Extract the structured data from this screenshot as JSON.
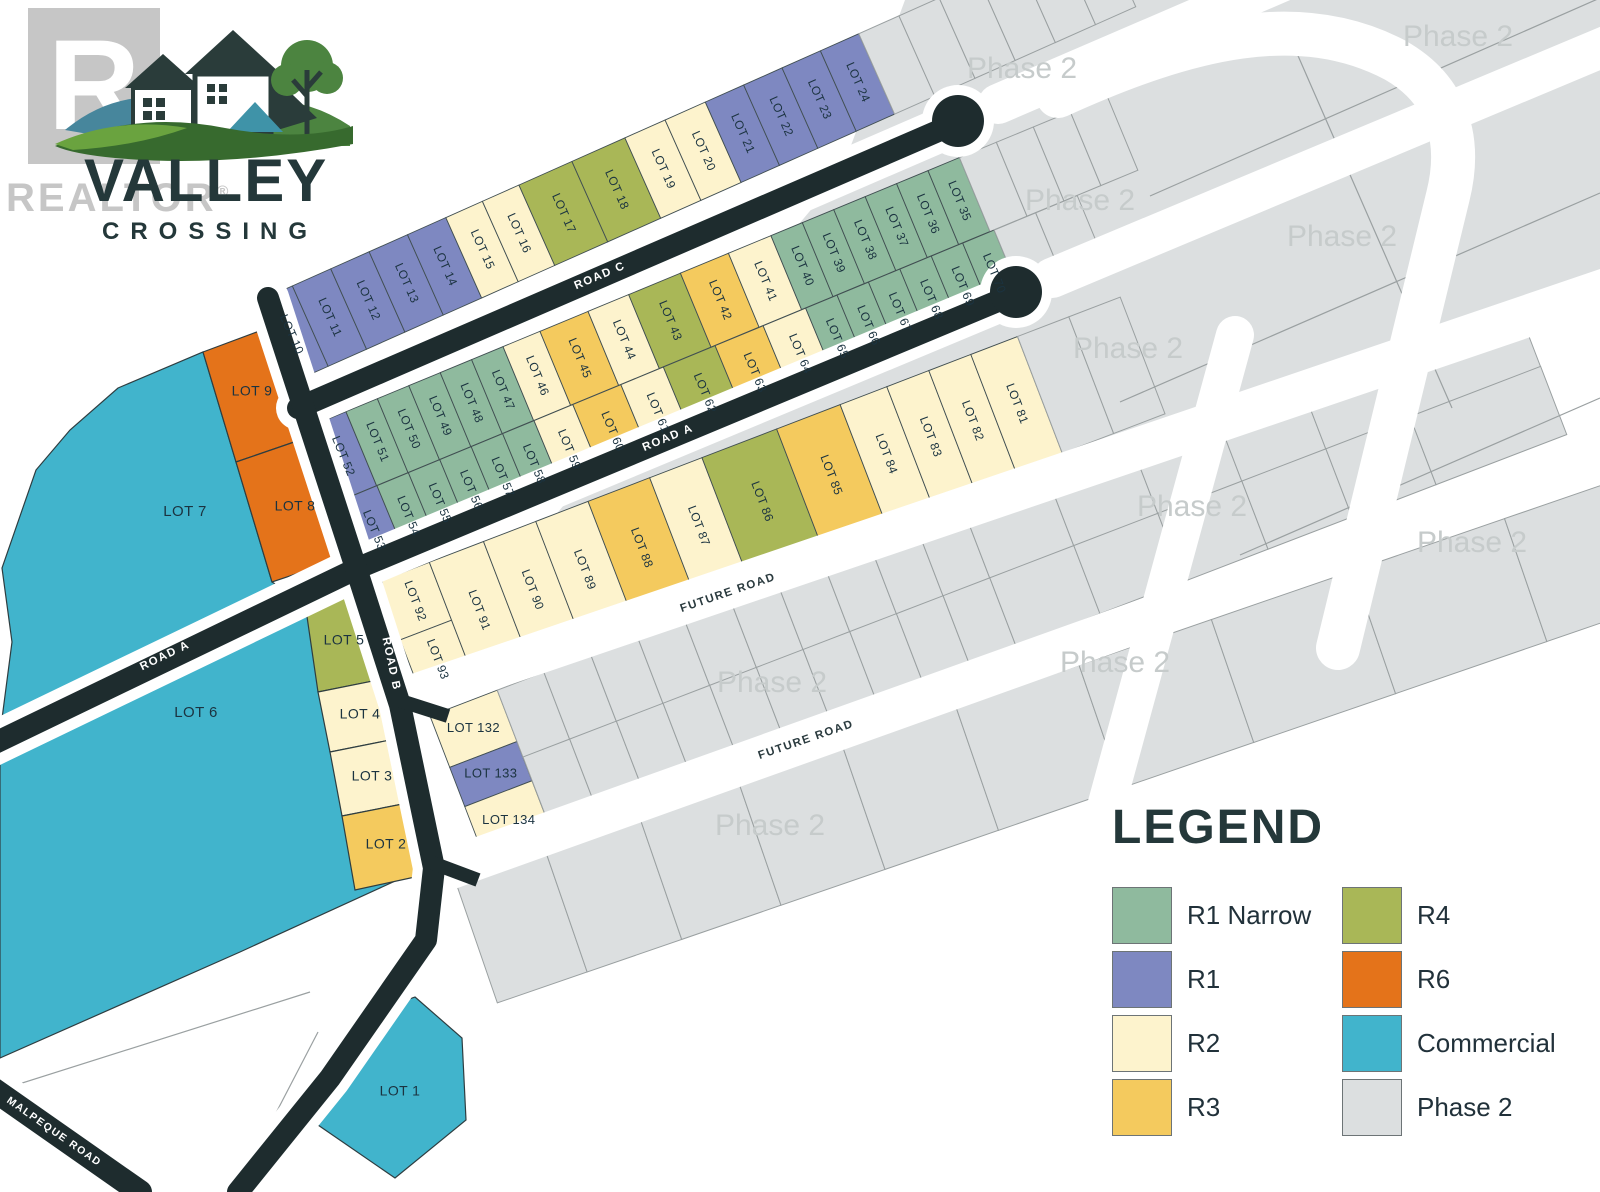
{
  "palette": {
    "r1n": "#8fba9e",
    "r1": "#7e88c1",
    "r2": "#fdf3cd",
    "r3": "#f4ca5e",
    "r4": "#a9b757",
    "r6": "#e4731a",
    "com": "#41b4cc",
    "ph2": "#dcdfe0",
    "road": "#1e2c2e",
    "lot_stroke": "#41505338",
    "label": "#1b3340",
    "ph2_stroke": "#9aa0a1",
    "watermark": "#c6cbcb"
  },
  "logo": {
    "title": "VALLEY",
    "subtitle": "CROSSING",
    "watermark_letter": "R",
    "watermark_text": "REALTOR",
    "registered": "®"
  },
  "legend": {
    "title": "LEGEND",
    "items": [
      {
        "label": "R1 Narrow",
        "zone": "r1n"
      },
      {
        "label": "R4",
        "zone": "r4"
      },
      {
        "label": "R1",
        "zone": "r1"
      },
      {
        "label": "R6",
        "zone": "r6"
      },
      {
        "label": "R2",
        "zone": "r2"
      },
      {
        "label": "Commercial",
        "zone": "com"
      },
      {
        "label": "R3",
        "zone": "r3"
      },
      {
        "label": "Phase 2",
        "zone": "ph2"
      }
    ]
  },
  "map": {
    "watermark_text": "Phase 2",
    "base": {
      "pts": "840,175 905,0 1600,0 1600,286 405,695"
    },
    "rows": [
      {
        "id": "band-1-north-of-road-c",
        "ox": 254,
        "oy": 303,
        "a": -24,
        "h": 88,
        "cells": [
          [
            "LOT 10",
            "r1",
            42
          ],
          [
            "LOT 11",
            "r1",
            42
          ],
          [
            "LOT 12",
            "r1",
            42
          ],
          [
            "LOT 13",
            "r1",
            42
          ],
          [
            "LOT 14",
            "r1",
            42
          ],
          [
            "LOT 15",
            "r2",
            40
          ],
          [
            "LOT 16",
            "r2",
            40
          ],
          [
            "LOT 17",
            "r4",
            58
          ],
          [
            "LOT 18",
            "r4",
            58
          ],
          [
            "LOT 19",
            "r2",
            44
          ],
          [
            "LOT 20",
            "r2",
            44
          ],
          [
            "LOT 21",
            "r1",
            42
          ],
          [
            "LOT 22",
            "r1",
            42
          ],
          [
            "LOT 23",
            "r1",
            42
          ],
          [
            "LOT 24",
            "r1",
            42
          ],
          [
            "",
            "ph2",
            44
          ],
          [
            "",
            "ph2",
            44
          ],
          [
            "",
            "ph2",
            44
          ],
          [
            "",
            "ph2",
            44
          ],
          [
            "",
            "ph2",
            44
          ],
          [
            "",
            "ph2",
            44
          ]
        ]
      },
      {
        "id": "band-2-facing-road-c",
        "ox": 309,
        "oy": 427,
        "a": -22.5,
        "h": 80,
        "cells": [
          [
            "LOT 52",
            "r1",
            40
          ],
          [
            "LOT 51",
            "r1n",
            34
          ],
          [
            "LOT 50",
            "r1n",
            34
          ],
          [
            "LOT 49",
            "r1n",
            34
          ],
          [
            "LOT 48",
            "r1n",
            34
          ],
          [
            "LOT 47",
            "r1n",
            34
          ],
          [
            "LOT 46",
            "r2",
            40
          ],
          [
            "LOT 45",
            "r3",
            52
          ],
          [
            "LOT 44",
            "r2",
            44
          ],
          [
            "LOT 43",
            "r4",
            56
          ],
          [
            "LOT 42",
            "r3",
            52
          ],
          [
            "LOT 41",
            "r2",
            46
          ],
          [
            "LOT 40",
            "r1n",
            34
          ],
          [
            "LOT 39",
            "r1n",
            34
          ],
          [
            "LOT 38",
            "r1n",
            34
          ],
          [
            "LOT 37",
            "r1n",
            34
          ],
          [
            "LOT 36",
            "r1n",
            34
          ],
          [
            "LOT 35",
            "r1n",
            34
          ],
          [
            "",
            "ph2",
            40
          ],
          [
            "",
            "ph2",
            40
          ],
          [
            "",
            "ph2",
            40
          ],
          [
            "",
            "ph2",
            40
          ]
        ]
      },
      {
        "id": "band-2-facing-road-a",
        "ox": 340,
        "oy": 501,
        "a": -22.5,
        "h": 80,
        "cells": [
          [
            "LOT 53",
            "r1",
            40
          ],
          [
            "LOT 54",
            "r1n",
            34
          ],
          [
            "LOT 55",
            "r1n",
            34
          ],
          [
            "LOT 56",
            "r1n",
            34
          ],
          [
            "LOT 57",
            "r1n",
            34
          ],
          [
            "LOT 58",
            "r1n",
            34
          ],
          [
            "LOT 59",
            "r2",
            42
          ],
          [
            "LOT 60",
            "r3",
            52
          ],
          [
            "LOT 61",
            "r2",
            46
          ],
          [
            "LOT 62",
            "r4",
            56
          ],
          [
            "LOT 63",
            "r3",
            52
          ],
          [
            "LOT 64",
            "r2",
            46
          ],
          [
            "LOT 65",
            "r1n",
            34
          ],
          [
            "LOT 66",
            "r1n",
            34
          ],
          [
            "LOT 67",
            "r1n",
            34
          ],
          [
            "LOT 68",
            "r1n",
            34
          ],
          [
            "LOT 69",
            "r1n",
            34
          ],
          [
            "LOT 70",
            "r1n",
            34
          ],
          [
            "",
            "ph2",
            45
          ],
          [
            "",
            "ph2",
            45
          ]
        ]
      },
      {
        "id": "band-3-south-of-road-a",
        "ox": 378,
        "oy": 582,
        "a": -21,
        "h": 125,
        "cells": [
          [
            "LOT 92",
            "r2",
            55,
            62
          ],
          [
            "LOT 93",
            "r2",
            55,
            63,
            62,
            1
          ],
          [
            "LOT 91",
            "r2",
            58
          ],
          [
            "LOT 90",
            "r2",
            56
          ],
          [
            "LOT 89",
            "r2",
            56
          ],
          [
            "LOT 88",
            "r3",
            66
          ],
          [
            "LOT 87",
            "r2",
            56
          ],
          [
            "LOT 86",
            "r4",
            80
          ],
          [
            "LOT 85",
            "r3",
            68
          ],
          [
            "LOT 84",
            "r2",
            50
          ],
          [
            "LOT 83",
            "r2",
            45
          ],
          [
            "LOT 82",
            "r2",
            45
          ],
          [
            "LOT 81",
            "r2",
            50
          ],
          [
            "",
            "ph2",
            55
          ],
          [
            "",
            "ph2",
            55
          ]
        ]
      },
      {
        "id": "band-4-between-future-roads",
        "ox": 430,
        "oy": 716,
        "a": -21,
        "h": 145,
        "cells": [
          [
            "LOT 132",
            "r2",
            72,
            55,
            0,
            0,
            1
          ],
          [
            "LOT 133",
            "r1",
            72,
            42,
            55,
            1,
            1
          ],
          [
            "LOT 134",
            "r2",
            72,
            58,
            97,
            1,
            1
          ],
          [
            "",
            "ph2",
            50,
            72
          ],
          [
            "",
            "ph2",
            50,
            72
          ],
          [
            "",
            "ph2",
            50,
            72
          ],
          [
            "",
            "ph2",
            50,
            72
          ],
          [
            "",
            "ph2",
            50,
            72
          ],
          [
            "",
            "ph2",
            50,
            72
          ],
          [
            "",
            "ph2",
            50,
            72
          ],
          [
            "",
            "ph2",
            50,
            72
          ],
          [
            "",
            "ph2",
            50,
            72
          ],
          [
            "",
            "ph2",
            50,
            72
          ],
          [
            "",
            "ph2",
            90,
            72
          ],
          [
            "",
            "ph2",
            90,
            72
          ],
          [
            "",
            "ph2",
            90,
            72
          ],
          [
            "",
            "ph2",
            90,
            72
          ],
          [
            "",
            "ph2",
            90,
            72
          ],
          [
            "",
            "ph2",
            140,
            72
          ]
        ]
      },
      {
        "id": "band-4-lower-row",
        "ox": 523,
        "oy": 757,
        "a": -21,
        "h": 73,
        "cells": [
          [
            "",
            "ph2",
            50
          ],
          [
            "",
            "ph2",
            50
          ],
          [
            "",
            "ph2",
            50
          ],
          [
            "",
            "ph2",
            50
          ],
          [
            "",
            "ph2",
            50
          ],
          [
            "",
            "ph2",
            50
          ],
          [
            "",
            "ph2",
            50
          ],
          [
            "",
            "ph2",
            50
          ],
          [
            "",
            "ph2",
            50
          ],
          [
            "",
            "ph2",
            50
          ],
          [
            "",
            "ph2",
            90
          ],
          [
            "",
            "ph2",
            90
          ],
          [
            "",
            "ph2",
            90
          ],
          [
            "",
            "ph2",
            90
          ],
          [
            "",
            "ph2",
            90
          ],
          [
            "",
            "ph2",
            140
          ]
        ]
      },
      {
        "id": "band-5-south-of-future-road-2",
        "ox": 455,
        "oy": 880,
        "a": -19,
        "h": 130,
        "cells": [
          [
            "",
            "ph2",
            95
          ],
          [
            "",
            "ph2",
            100
          ],
          [
            "",
            "ph2",
            105
          ],
          [
            "",
            "ph2",
            110
          ],
          [
            "",
            "ph2",
            120
          ],
          [
            "",
            "ph2",
            130
          ],
          [
            "",
            "ph2",
            140
          ],
          [
            "",
            "ph2",
            150
          ],
          [
            "",
            "ph2",
            160
          ],
          [
            "",
            "ph2",
            115
          ]
        ]
      }
    ],
    "polys": [
      {
        "t": "LOT 7",
        "z": "com",
        "pts": "118,388 203,352 236,462 272,582 288,592 0,734 12,642 2,568 36,470 70,430",
        "lx": 185,
        "ly": 512,
        "fs": 15
      },
      {
        "t": "LOT 9",
        "z": "r6",
        "pts": "203,352 262,330 300,440 236,462",
        "lx": 252,
        "ly": 392,
        "fs": 14
      },
      {
        "t": "LOT 8",
        "z": "r6",
        "pts": "236,462 300,440 338,560 272,582",
        "lx": 295,
        "ly": 507,
        "fs": 14
      },
      {
        "t": "LOT 6",
        "z": "com",
        "pts": "0,762 350,590 370,660 396,706 428,866 240,952 0,1058",
        "lx": 196,
        "ly": 713,
        "fs": 15
      },
      {
        "t": "LOT 5",
        "z": "r4",
        "pts": "304,596 382,582 398,676 318,692",
        "lx": 344,
        "ly": 641,
        "fs": 14
      },
      {
        "t": "LOT 4",
        "z": "r2",
        "pts": "318,692 398,676 410,736 330,752",
        "lx": 360,
        "ly": 715,
        "fs": 14
      },
      {
        "t": "LOT 3",
        "z": "r2",
        "pts": "330,752 410,736 423,800 342,816",
        "lx": 372,
        "ly": 777,
        "fs": 14
      },
      {
        "t": "LOT 2",
        "z": "r3",
        "pts": "342,816 423,800 438,872 355,890",
        "lx": 386,
        "ly": 845,
        "fs": 14
      },
      {
        "t": "LOT 1",
        "z": "com",
        "pts": "415,997 462,1038 466,1120 395,1178 318,1125 362,1015",
        "lx": 400,
        "ly": 1092,
        "fs": 14
      }
    ],
    "roads_dark": [
      {
        "name": "road-c",
        "pts": "298,408 952,125",
        "w": 22,
        "casing": 44,
        "bulb": [
          958,
          121
        ]
      },
      {
        "name": "road-a",
        "pts": "-30,755 358,568 1010,296",
        "w": 22,
        "casing": 44,
        "bulb": [
          1016,
          292
        ]
      },
      {
        "name": "road-b",
        "pts": "268,298 355,565 400,705 434,868 426,940 330,1078 238,1192",
        "w": 22,
        "casing": 42
      },
      {
        "name": "malpeque-road",
        "pts": "-20,1080 140,1192",
        "w": 24,
        "casing": 44
      }
    ],
    "stubs": [
      "398,700 448,716",
      "430,862 478,880"
    ],
    "roads_white": [
      {
        "pts": "998,104 1630,-168",
        "w": 40
      },
      {
        "pts": "1052,278 1630,36",
        "w": 40
      },
      {
        "pts": "400,700 1630,281",
        "w": 42
      },
      {
        "pts": "440,872 1630,446",
        "w": 42
      },
      {
        "pts": "1235,335 1092,858",
        "w": 38
      },
      {
        "d": "M 1058 96 C 1190 36 1300 10 1395 60 C 1448 90 1462 140 1448 196 L 1338 648",
        "w": 44
      }
    ],
    "road_labels": [
      {
        "t": "ROAD C",
        "x": 600,
        "y": 276,
        "r": -23,
        "c": "w"
      },
      {
        "t": "ROAD A",
        "x": 165,
        "y": 656,
        "r": -26,
        "c": "w"
      },
      {
        "t": "ROAD A",
        "x": 668,
        "y": 438,
        "r": -22.5,
        "c": "w"
      },
      {
        "t": "ROAD B",
        "x": 391,
        "y": 664,
        "r": 78,
        "c": "w"
      },
      {
        "t": "MALPEQUE ROAD",
        "x": 54,
        "y": 1132,
        "r": 35,
        "c": "w",
        "fs": 10.5
      },
      {
        "t": "FUTURE ROAD",
        "x": 728,
        "y": 593,
        "r": -19,
        "c": "d"
      },
      {
        "t": "FUTURE ROAD",
        "x": 806,
        "y": 740,
        "r": -19,
        "c": "d"
      }
    ],
    "watermarks": [
      [
        1022,
        70
      ],
      [
        1458,
        38
      ],
      [
        1080,
        202
      ],
      [
        1342,
        238
      ],
      [
        1128,
        350
      ],
      [
        1192,
        508
      ],
      [
        1472,
        544
      ],
      [
        1115,
        664
      ],
      [
        772,
        684
      ],
      [
        770,
        827
      ]
    ],
    "lines": [
      [
        1292,
        42,
        1452,
        408
      ],
      [
        1150,
        196,
        1600,
        -2
      ],
      [
        1120,
        402,
        1600,
        193
      ],
      [
        1240,
        555,
        1600,
        398
      ],
      [
        310,
        992,
        0,
        1090
      ],
      [
        318,
        1032,
        236,
        1190
      ]
    ]
  }
}
